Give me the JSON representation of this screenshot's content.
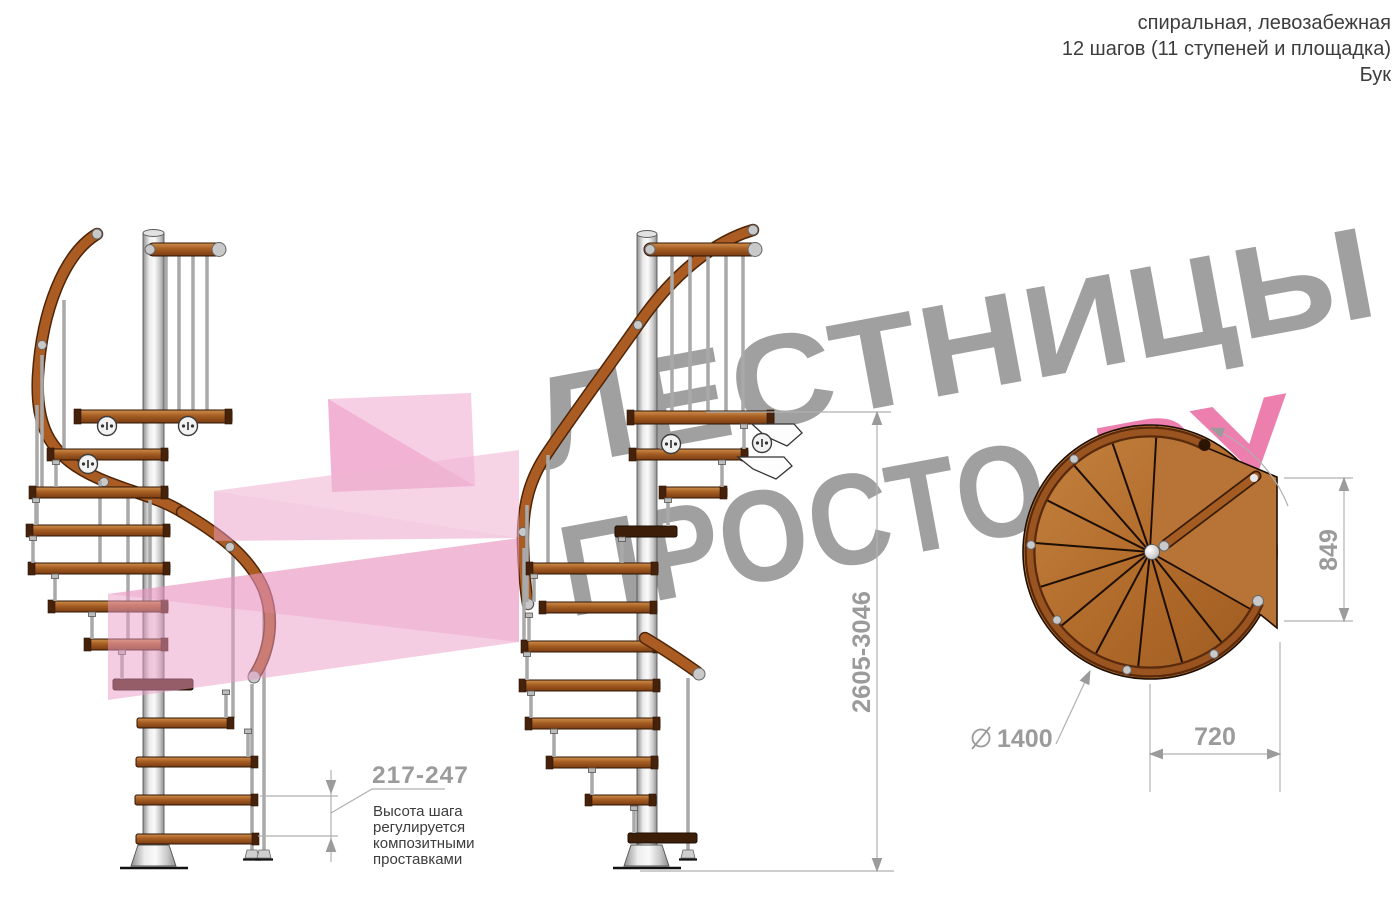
{
  "header": {
    "line1": "спиральная, левозабежная",
    "line2": "12 шагов (11 ступеней и площадка)",
    "line3": "Бук"
  },
  "watermark": {
    "word_top": "ЛЕСТНИЦЫ",
    "word_bottom": "ПРОСТО",
    "word_domain": ".РУ",
    "gray_color": "#a0a0a0",
    "pink_color": "#ec7fae",
    "logo_pink": "#ec93c4"
  },
  "dimensions": {
    "step_height": "217-247",
    "note_lines": [
      "Высота шага",
      "регулируется",
      "композитными",
      "проставками"
    ],
    "total_height": "2605-3046",
    "landing_side": "849",
    "diameter_value": "1400",
    "landing_width": "720"
  },
  "colors": {
    "wood_mid": "#a55d22",
    "wood_dark": "#4a2409",
    "metal": "#d9d9d9",
    "dimension_gray": "#9b9b9b",
    "note_text": "#3d3d3d"
  }
}
